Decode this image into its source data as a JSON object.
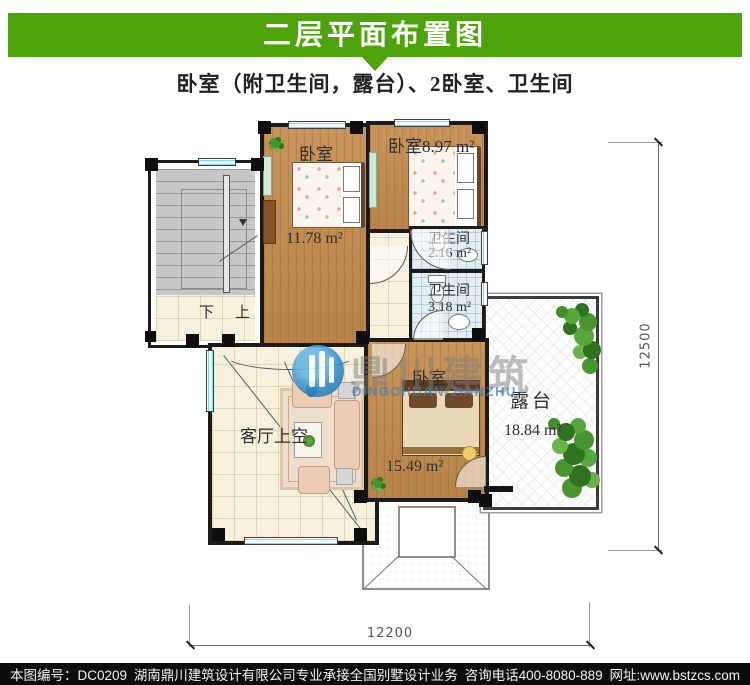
{
  "header": {
    "title": "二层平面布置图",
    "subtitle": "卧室（附卫生间，露台）、2卧室、卫生间"
  },
  "plan": {
    "rooms": {
      "bedroom1": {
        "label": "卧室",
        "area": "11.78 m²"
      },
      "bedroom2": {
        "label": "卧室8.97 m²"
      },
      "bath1": {
        "label": "卫生间",
        "area": "2.16 m²"
      },
      "bath2": {
        "label": "卫生间",
        "area": "3.18 m²"
      },
      "living": {
        "label": "客厅上空"
      },
      "bedroom3": {
        "label": "卧室",
        "area": "15.49 m²"
      },
      "terrace": {
        "label": "露台",
        "area": "18.84 m²"
      },
      "stairs": {
        "down": "下",
        "up": "上"
      }
    },
    "dimensions": {
      "right": "12500",
      "bottom": "12200"
    }
  },
  "watermark": {
    "cn": "鼎川建筑",
    "en": "DINGCHUAN JIANZHU"
  },
  "footer": {
    "drawing_no": "本图编号：DC0209",
    "company": "湖南鼎川建筑设计有限公司专业承接全国别墅设计业务",
    "phone": "咨询电话400-8080-889",
    "website": "网址:www.bstzcs.com"
  },
  "colors": {
    "accent_green": "#4ca30a",
    "footer_bg": "#0d0d0d",
    "wood": "#c08a4c",
    "tile_blue": "#e3eef4",
    "tile_beige": "#f6f0dc",
    "window_cyan": "#8fd2e4",
    "logo_blue": "#2a86c8"
  }
}
